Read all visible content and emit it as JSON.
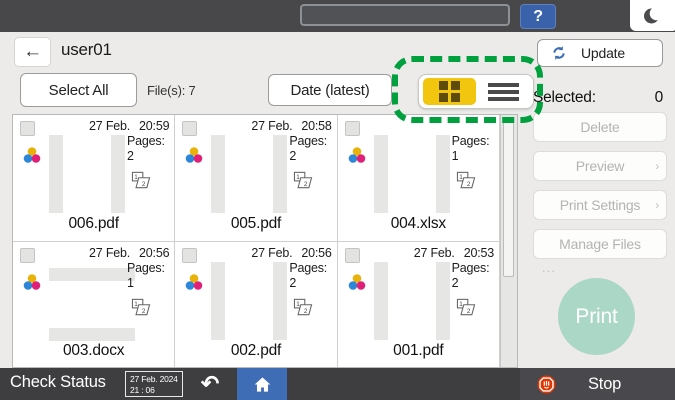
{
  "top_bar": {
    "input_value": "",
    "help_label": "?"
  },
  "header": {
    "back_glyph": "←",
    "title": "user01",
    "update_label": "Update"
  },
  "toolbar": {
    "select_all_label": "Select All",
    "file_count_label": "File(s): 7",
    "sort_label": "Date (latest)"
  },
  "view_toggle": {
    "selected": "grid"
  },
  "right_panel": {
    "selected_label": "Selected:",
    "selected_count": "0",
    "buttons": [
      {
        "label": "Delete",
        "suffix": ""
      },
      {
        "label": "Preview",
        "suffix": "›"
      },
      {
        "label": "Print Settings",
        "suffix": "›"
      },
      {
        "label": "Manage Files",
        "suffix": "..."
      }
    ],
    "print_label": "Print"
  },
  "files": [
    {
      "name": "006.pdf",
      "date": "27 Feb.",
      "time": "20:59",
      "pages_label": "Pages:",
      "pages": "2",
      "thumb": "v"
    },
    {
      "name": "005.pdf",
      "date": "27 Feb.",
      "time": "20:58",
      "pages_label": "Pages:",
      "pages": "2",
      "thumb": "v"
    },
    {
      "name": "004.xlsx",
      "date": "",
      "time": "",
      "pages_label": "Pages:",
      "pages": "1",
      "thumb": "v"
    },
    {
      "name": "003.docx",
      "date": "27 Feb.",
      "time": "20:56",
      "pages_label": "Pages:",
      "pages": "1",
      "thumb": "h"
    },
    {
      "name": "002.pdf",
      "date": "27 Feb.",
      "time": "20:56",
      "pages_label": "Pages:",
      "pages": "2",
      "thumb": "v"
    },
    {
      "name": "001.pdf",
      "date": "27 Feb.",
      "time": "20:53",
      "pages_label": "Pages:",
      "pages": "2",
      "thumb": "v"
    }
  ],
  "bottom_bar": {
    "check_status_label": "Check Status",
    "date": "27 Feb. 2024",
    "time": "21 : 06",
    "stop_label": "Stop"
  },
  "colors": {
    "accent_blue": "#3f6db5",
    "toggle_yellow": "#f2c50f",
    "highlight_green": "#00a03e",
    "print_mint": "#abd7c7",
    "stop_red": "#e23500"
  }
}
